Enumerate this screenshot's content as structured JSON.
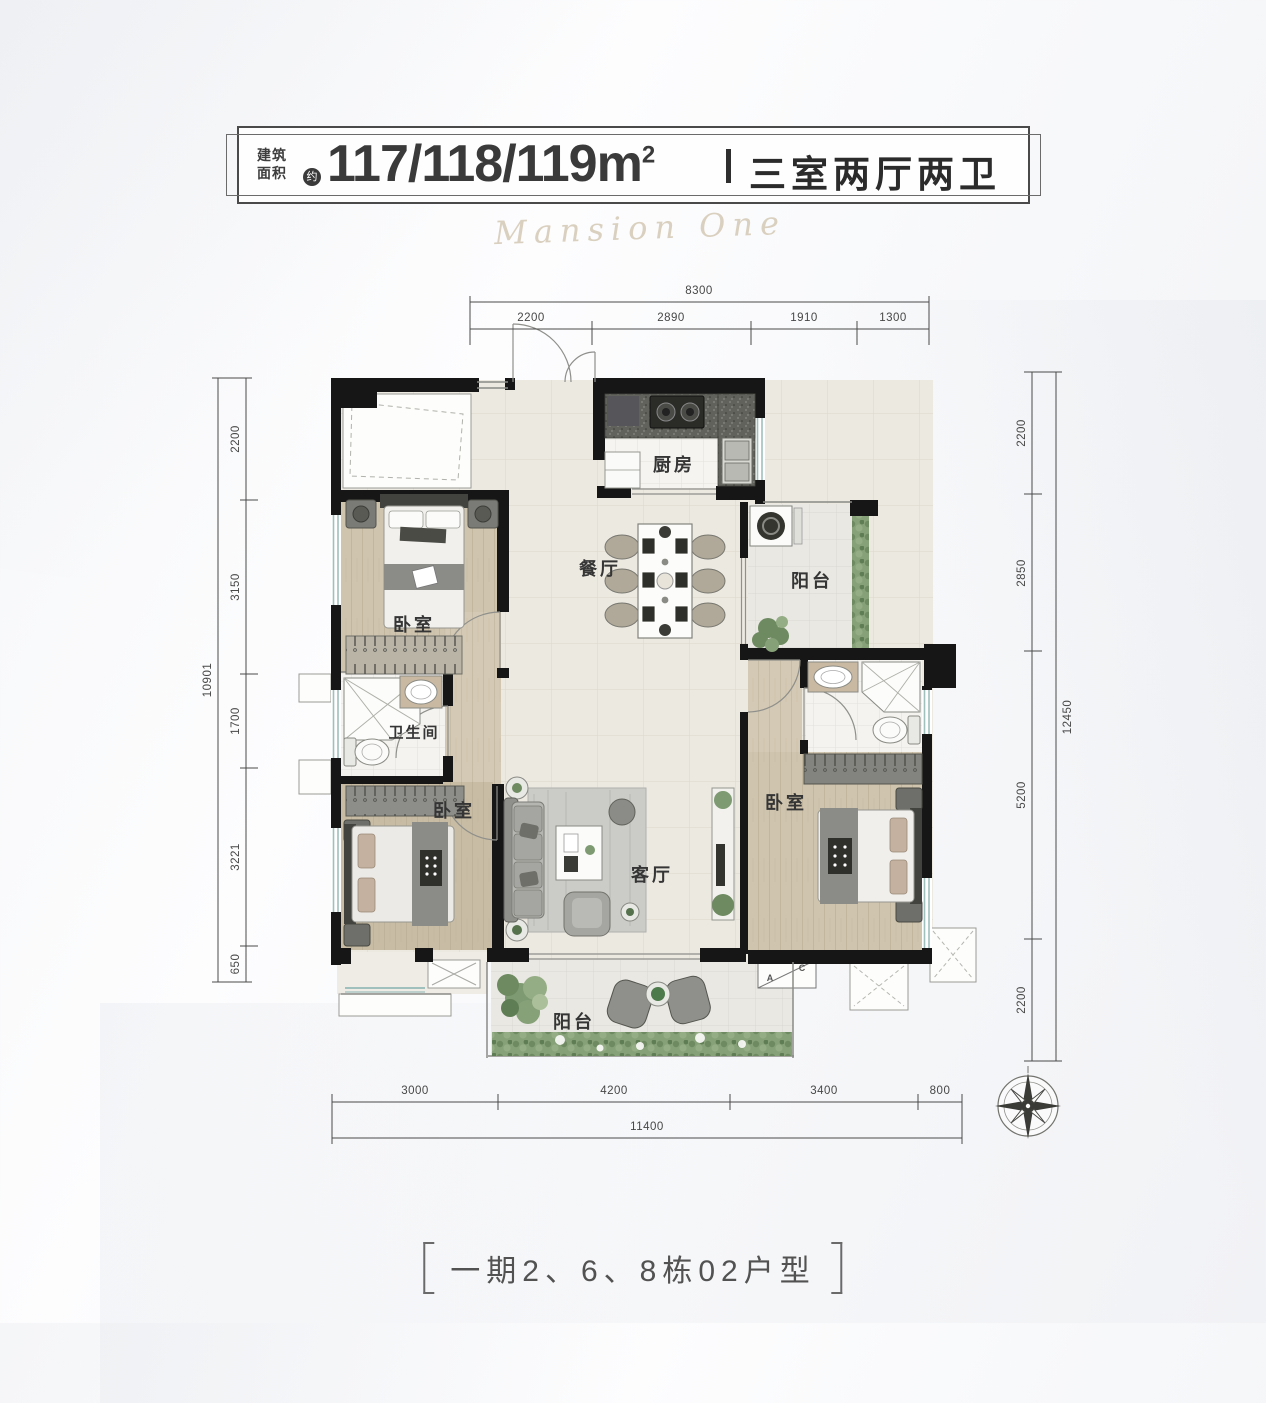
{
  "header": {
    "area_label": "建筑\n面积",
    "approx": "约",
    "area_value": "117/118/119m",
    "area_sup": "2",
    "layout": "三室两厅两卫"
  },
  "watermark": "Mansion One",
  "rooms": {
    "kitchen": "厨房",
    "dining": "餐厅",
    "service_balcony": "阳台",
    "bathroom": "卫生间",
    "bedroom_top": "卧室",
    "bedroom_left": "卧室",
    "bedroom_master": "卧室",
    "living": "客厅",
    "south_balcony": "阳台"
  },
  "ac_unit": {
    "a": "A",
    "c": "C"
  },
  "dimensions": {
    "top": {
      "total": "8300",
      "segments": [
        "2200",
        "2890",
        "1910",
        "1300"
      ]
    },
    "left": {
      "total": "10901",
      "segments": [
        "2200",
        "3150",
        "1700",
        "3221",
        "650"
      ]
    },
    "right": {
      "total": "12450",
      "segments": [
        "2200",
        "2850",
        "5200",
        "2200"
      ]
    },
    "bottom": {
      "total": "11400",
      "segments": [
        "3000",
        "4200",
        "3400",
        "800"
      ]
    }
  },
  "footer": {
    "caption": "一期2、6、8栋02户型"
  },
  "icons": {
    "compass": "compass-rose"
  },
  "colors": {
    "wall": "#161616",
    "window": "#9fc0bd",
    "wood_floor": "#cec2ac",
    "tile_floor": "#ece9e1",
    "white_floor": "#f5f4f0",
    "balcony_floor": "#e9e8e3",
    "plant_green": "#7d9a72",
    "granite": "#5a5a56",
    "text": "#3c3c3c"
  }
}
